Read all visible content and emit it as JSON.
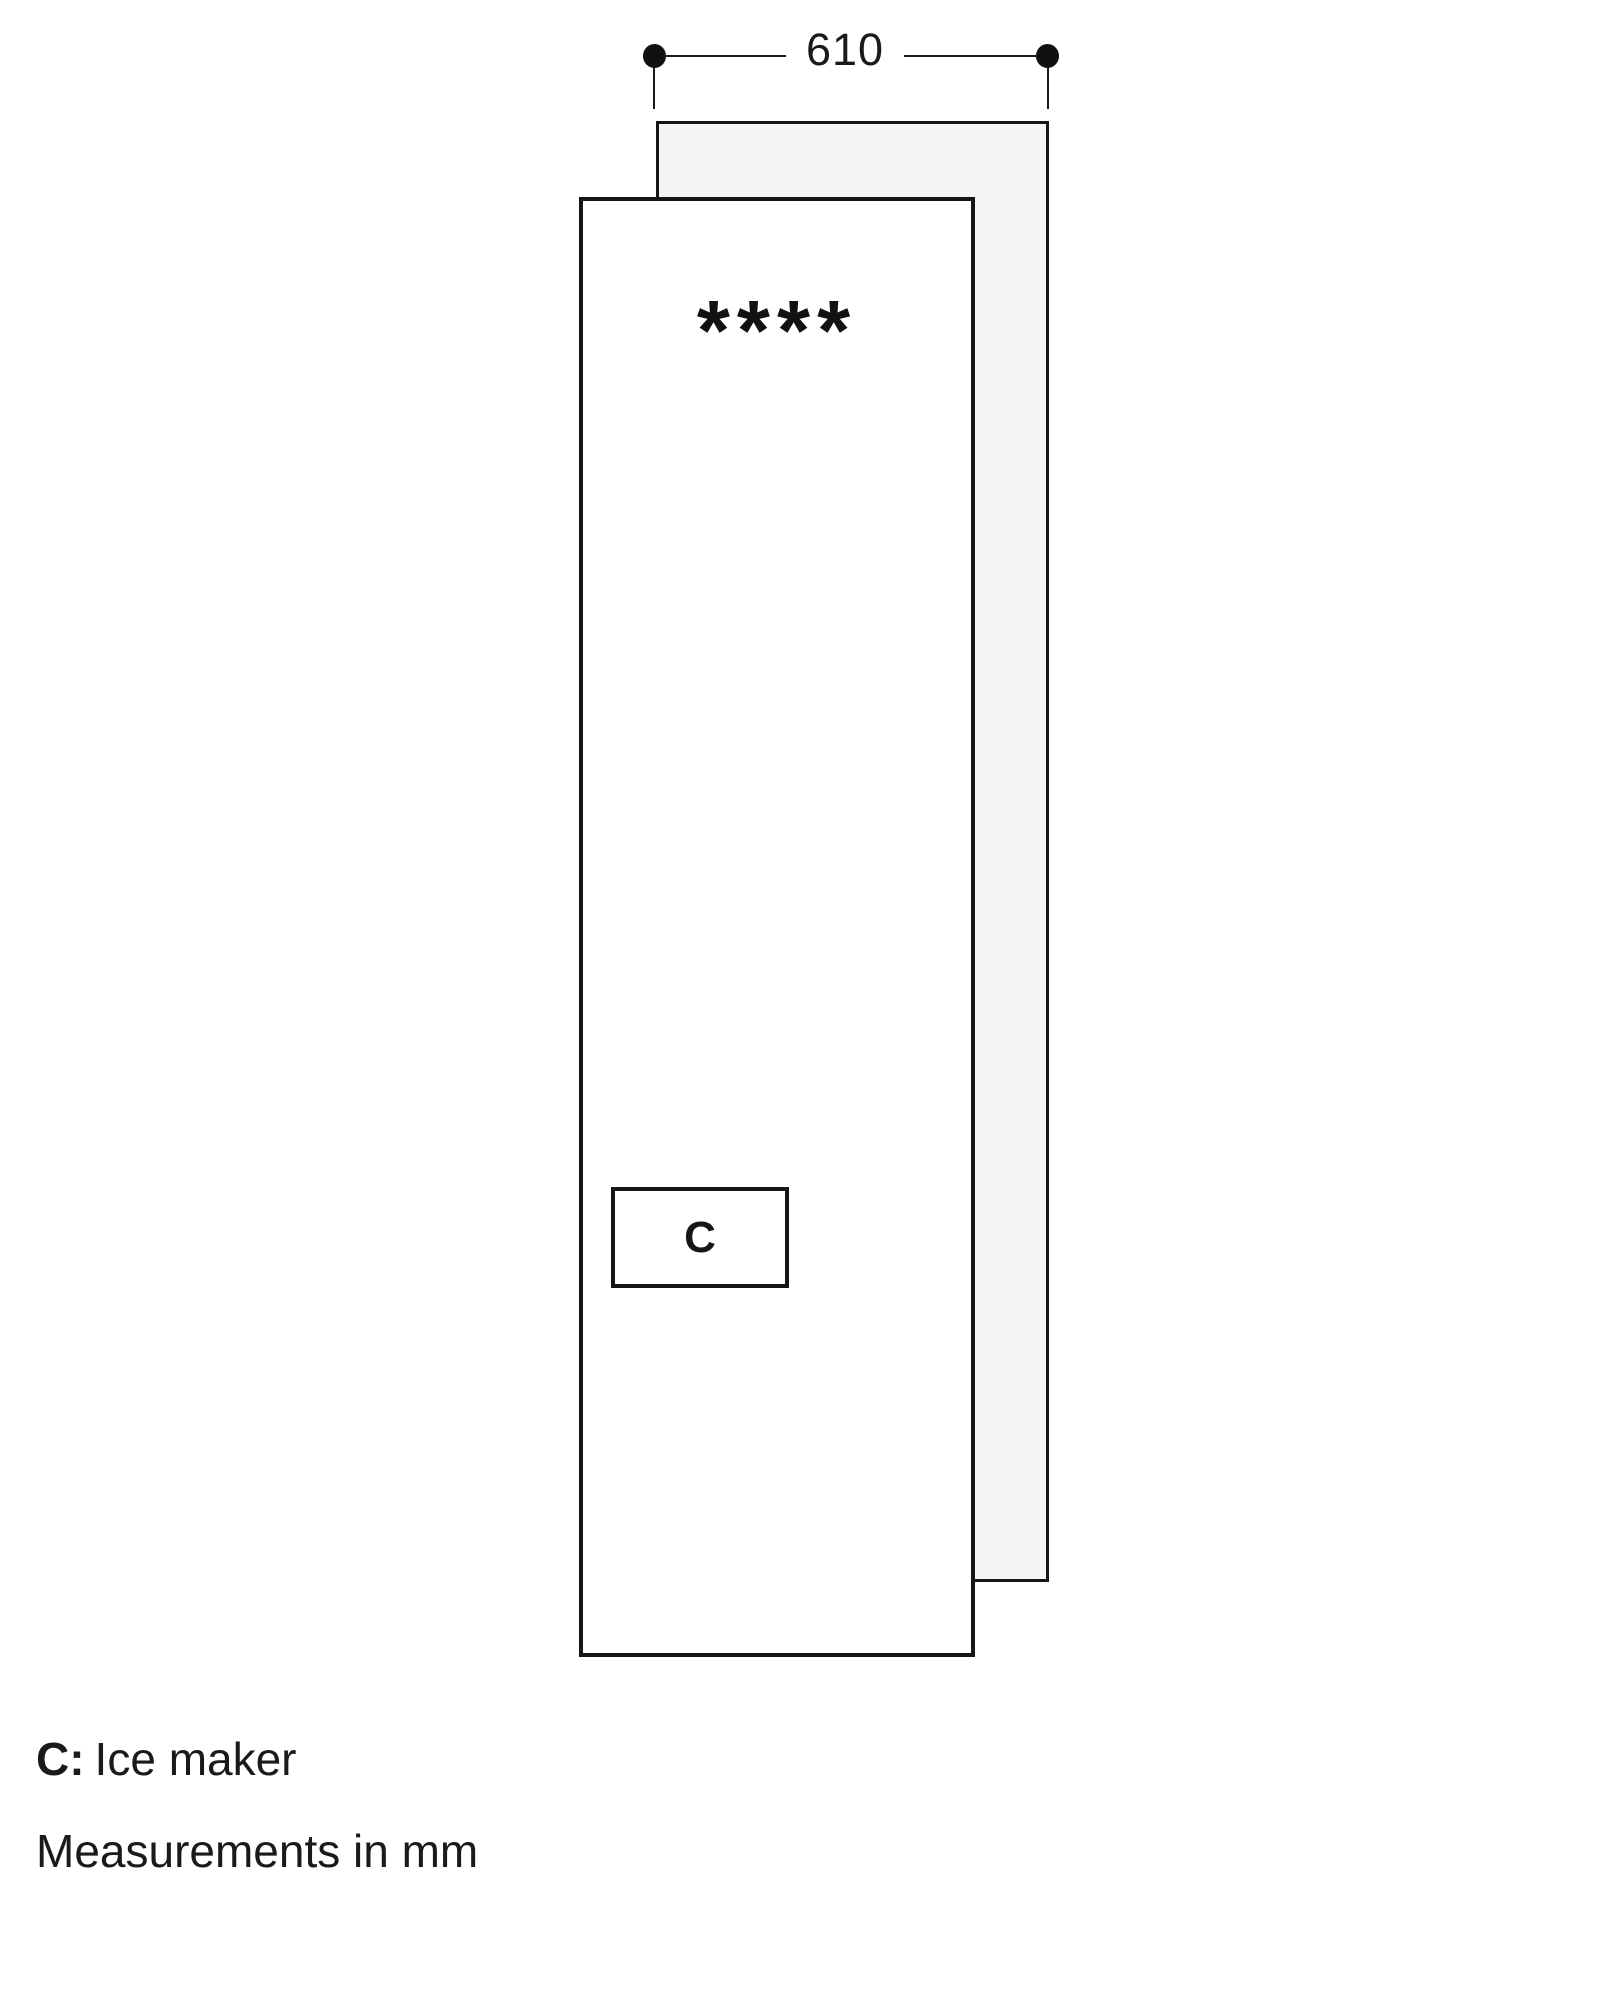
{
  "diagram": {
    "dimension_label": "610",
    "star_rating": "****",
    "compartment_label": "C"
  },
  "legend": {
    "key": "C:",
    "description": "Ice maker",
    "units_note": "Measurements in mm"
  },
  "colors": {
    "line": "#1a1a1a",
    "back_panel_fill": "#f5f5f6",
    "background": "#ffffff"
  }
}
